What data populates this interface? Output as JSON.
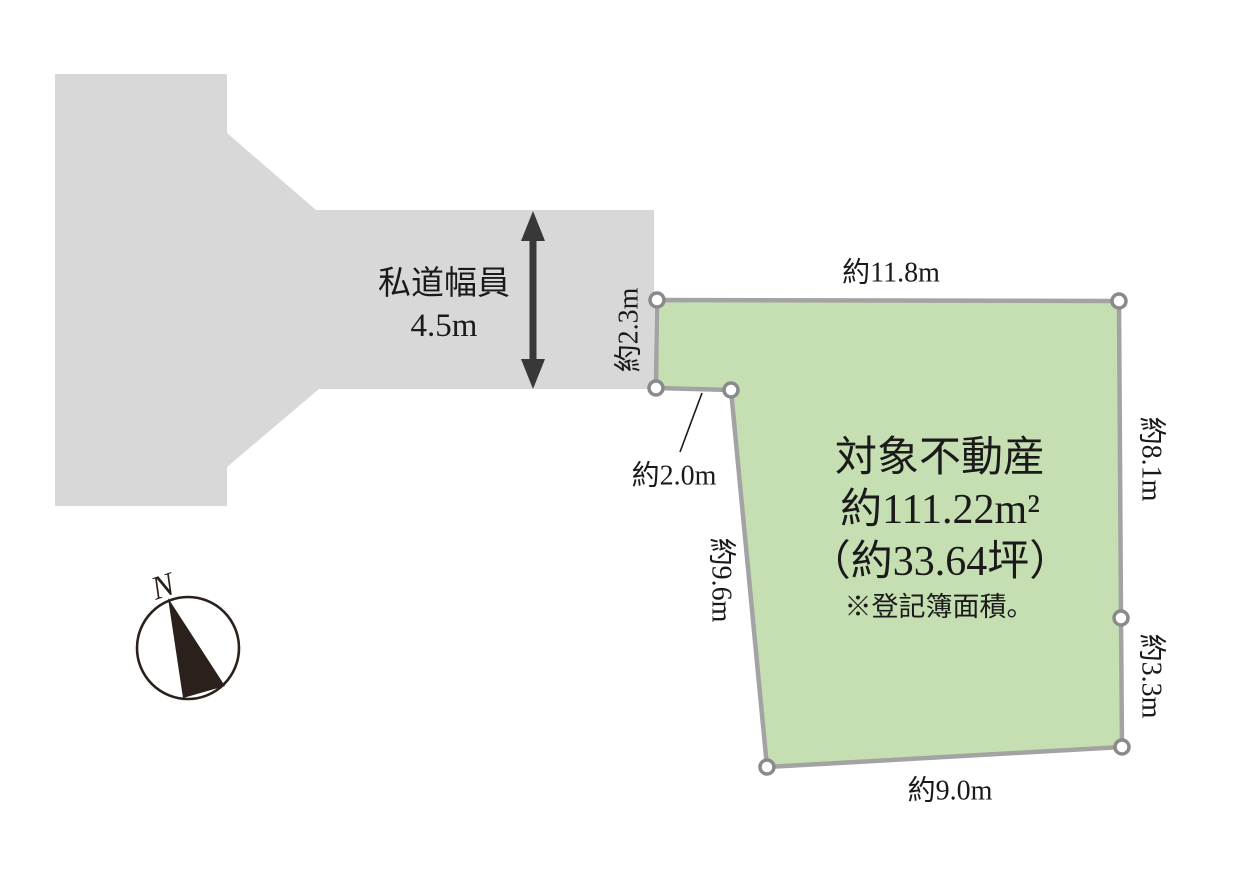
{
  "road": {
    "name_label": "私道幅員",
    "width_label": "4.5m"
  },
  "plot": {
    "title": "対象不動産",
    "area_m2": "約111.22m²",
    "area_tsubo": "（約33.64坪）",
    "note": "※登記簿面積。"
  },
  "dimensions": {
    "top_edge": "約11.8m",
    "frontage_left": "約2.3m",
    "notch": "約2.0m",
    "west_edge": "約9.6m",
    "east_upper_edge": "約8.1m",
    "east_lower_edge": "約3.3m",
    "south_edge": "約9.0m"
  },
  "compass": {
    "north_label": "N"
  },
  "colors": {
    "road_fill": "#d8d8d8",
    "plot_fill": "#c5dfb2",
    "plot_border": "#a3a3a3",
    "vertex_ring": "#8a8a8a",
    "text": "#1a1a1a",
    "arrow": "#383838",
    "compass_ink": "#2b211c"
  }
}
